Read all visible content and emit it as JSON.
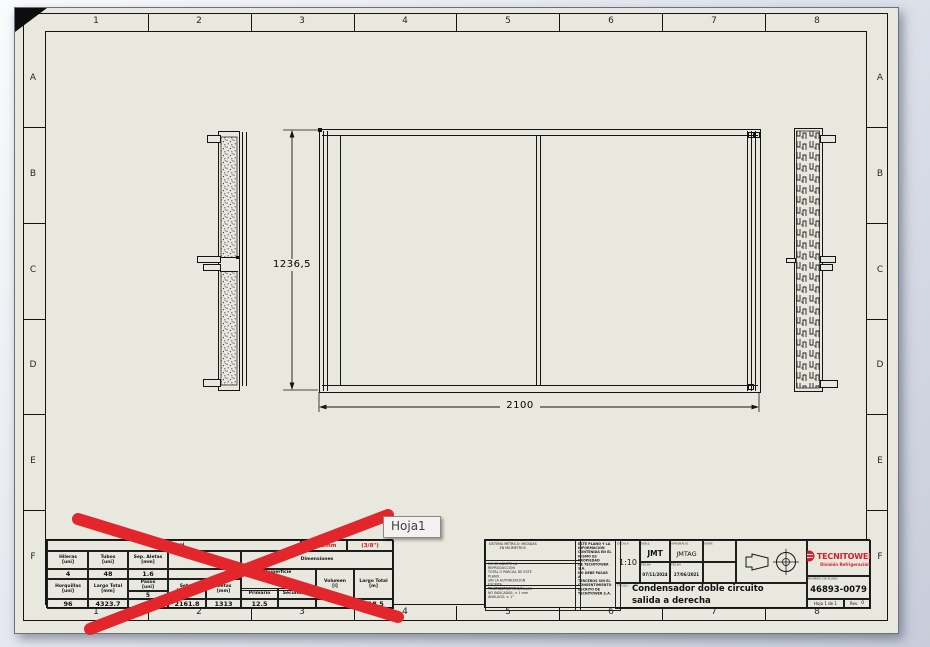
{
  "sheet": {
    "cols": [
      "1",
      "2",
      "3",
      "4",
      "5",
      "6",
      "7",
      "8"
    ],
    "rows": [
      "A",
      "B",
      "C",
      "D",
      "E",
      "F"
    ]
  },
  "drawing": {
    "dim_height": "1236,5",
    "dim_width": "2100"
  },
  "tooltip": {
    "label": "Hoja1"
  },
  "annotation": {
    "cross_color": "#e2262c"
  },
  "parts_table": {
    "general": "General",
    "tube_red_1": "9.52mm",
    "tube_red_2": "(3/8\")",
    "h_hileras": "Hileras\n[uni]",
    "h_tubos": "Tubos\n[uni]",
    "h_sep_aletas": "Sep. Aletas\n[mm]",
    "h_ec": "EC",
    "h_dimensiones": "Dimensiones",
    "v_hileras": "4",
    "v_tubos": "48",
    "v_sep_aletas": "1.6",
    "v_ec": "",
    "h_superficie": "Superficie",
    "h_horquillas": "Horquillas\n[uni]",
    "h_largo_total_mm": "Largo Total\n[mm]",
    "h_pasos": "Pasos\n[uni]",
    "v_pasos_sub": "5",
    "h_seteo": "Seteo\nDoblado",
    "h_aletas": "Aletas\n[mm]",
    "h_primario": "Primario",
    "h_secundario": "Secundario",
    "h_volumen": "Volumen\n[l]",
    "h_largo_total_m": "Largo Total\n[m]",
    "v_horquillas": "96",
    "v_largo_total_mm": "4323.7",
    "v_pasos": "",
    "v_seteo": "2161.8",
    "v_aletas": "1313",
    "v_primario": "12.5",
    "v_secundario": "",
    "v_volumen": "",
    "v_largo_total_m": "418.5"
  },
  "title_block": {
    "notes_a": "SISTEMA MÉTRICO: MEDIDAS\nEN MILÍMETROS",
    "notes_b": "NO SE ADMITE LA REPRODUCCIÓN\nTOTAL O PARCIAL DE ESTE PLANO\nSIN LA AUTORIZACIÓN ESCRITA\nDE TECNITOWER S.A.",
    "notes_c": "TOLERANCIAS GENERALES\nNO INDICADAS: ± 1 mm\nÁNGULOS: ± 1°",
    "property_note": "ESTE PLANO Y LA\nINFORMACIÓN\nCONTENIDA EN EL\nMISMO ES PROPIEDAD\nDE TECNITOWER S.A.\nNO DEBE PASAR A\nTERCEROS SIN EL\nCONSENTIMIENTO\nESCRITO DE\nTECNITOWER S.A.",
    "scale_label": "ESCALA",
    "scale": "1:10",
    "drawn_label": "DIBUJ.",
    "drawn": "JMT",
    "checked_label": "APROBADO",
    "checked": "JMTAG",
    "third_label": "VERIF.",
    "date_label": "FECHA",
    "drawn_date": "07/11/2024",
    "checked_date": "27/06/2021",
    "title_label": "TÍTULO:",
    "title": "Condensador doble circuito\nsalida a derecha",
    "company": "TECNITOWER",
    "company_sub": "División Refrigeración",
    "number_label": "NÚMERO DE PLANO",
    "number": "46893-0079",
    "sheet_info": "Hoja 1 de 1",
    "rev_label": "Rev.",
    "rev": "0",
    "brand_color": "#d31f26"
  }
}
